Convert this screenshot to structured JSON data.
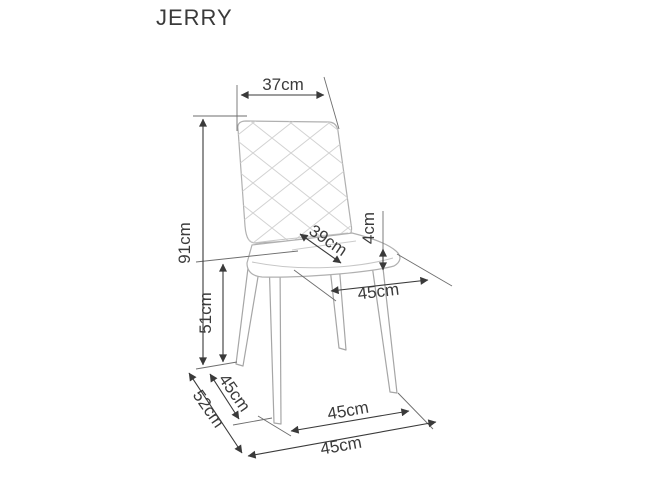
{
  "page": {
    "background": "#ffffff"
  },
  "header": {
    "title": "JERRY"
  },
  "style": {
    "dimension_line_color": "#3a3a3a",
    "extension_line_color": "#6e6e6e",
    "chair_outline_color": "#b0b0b0",
    "quilt_pattern_color": "#d2d2d2",
    "label_color": "#3b3b3b"
  },
  "diagram": {
    "type": "furniture-dimension-drawing",
    "product_name": "JERRY chair",
    "unit": "cm",
    "dimensions": {
      "backrest_width": {
        "label": "37cm",
        "value": 37
      },
      "total_height": {
        "label": "91cm",
        "value": 91
      },
      "seat_height": {
        "label": "51cm",
        "value": 51
      },
      "seat_cushion_depth": {
        "label": "39cm",
        "value": 39
      },
      "cushion_thickness": {
        "label": "4cm",
        "value": 4
      },
      "seat_width": {
        "label": "45cm",
        "value": 45
      },
      "total_depth": {
        "label": "52cm",
        "value": 52
      },
      "leg_span_side": {
        "label": "45cm",
        "value": 45
      },
      "leg_span_front": {
        "label": "45cm",
        "value": 45
      },
      "base_width": {
        "label": "45cm",
        "value": 45
      }
    }
  }
}
